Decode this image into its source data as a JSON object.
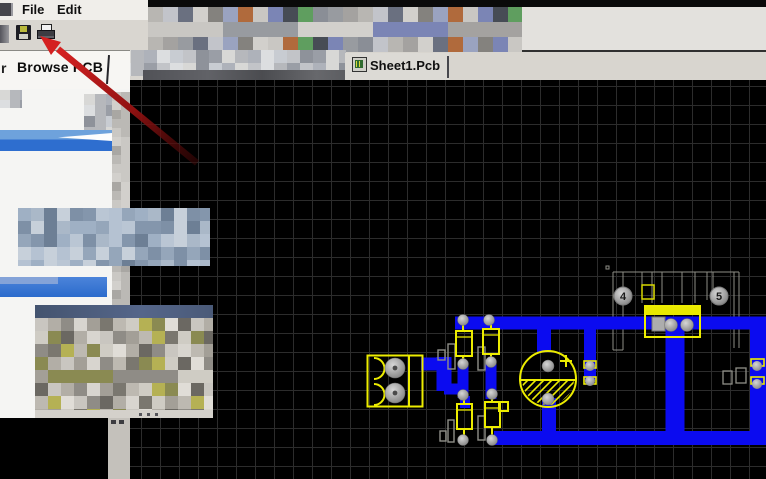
{
  "menu_bar": {
    "items": [
      {
        "label": "File"
      },
      {
        "label": "Edit"
      }
    ]
  },
  "toolbar": {
    "buttons": [
      {
        "name": "save",
        "icon": "floppy-disk-icon"
      },
      {
        "name": "print",
        "icon": "printer-icon"
      }
    ]
  },
  "panel_tabs": {
    "partial_tab_label": "r",
    "active_tab_label": "Browse PCB"
  },
  "document_tabs": {
    "tabs": [
      {
        "label": "Sheet1.Pcb",
        "icon": "pcb-file-icon",
        "active": true
      }
    ]
  },
  "pcb_view": {
    "background": "#000000",
    "grid_color": "#2c2c2c",
    "grid_size_px": 19,
    "trace_color": "#0b0bf0",
    "silkscreen_color": "#ecec00",
    "pad_color": "#aaaaaa",
    "pad_designators": [
      {
        "label": "4"
      },
      {
        "label": "5"
      }
    ]
  },
  "annotation": {
    "type": "arrow",
    "color": "#d42020",
    "points_at": "print-button"
  },
  "censor_palettes": {
    "toolbar": [
      "#b8b6b2",
      "#a4a2a0",
      "#989ba0",
      "#8a8e96",
      "#5f9e5f",
      "#474c55",
      "#7b85b5",
      "#c9c7c3",
      "#b06a3c",
      "#9aa3c0",
      "#84827e",
      "#d2d0cc",
      "#6a7080",
      "#c2c4ca"
    ],
    "panel": [
      "#d8d8d6",
      "#c2c4c8",
      "#aeb2ba",
      "#9a9ea6",
      "#c8ccd2",
      "#b6b8bc",
      "#8e929a",
      "#dcdee0"
    ],
    "bluegray": [
      "#9fb0c4",
      "#b5c2d2",
      "#8496ac",
      "#c7d0da",
      "#aab8c8",
      "#95a6ba",
      "#bac6d4",
      "#7e90a6",
      "#6d7f95"
    ],
    "window": [
      "#c9c6c0",
      "#b2aea6",
      "#8f8c86",
      "#d8d5cf",
      "#a39f97",
      "#7a776f",
      "#bdb9b1",
      "#cfccc4",
      "#b5b154",
      "#8a8a52",
      "#e0ddd7",
      "#6b6862"
    ],
    "strip": [
      "#cac8c4",
      "#bbb9b5",
      "#a9a7a3",
      "#d2d0cc"
    ]
  }
}
